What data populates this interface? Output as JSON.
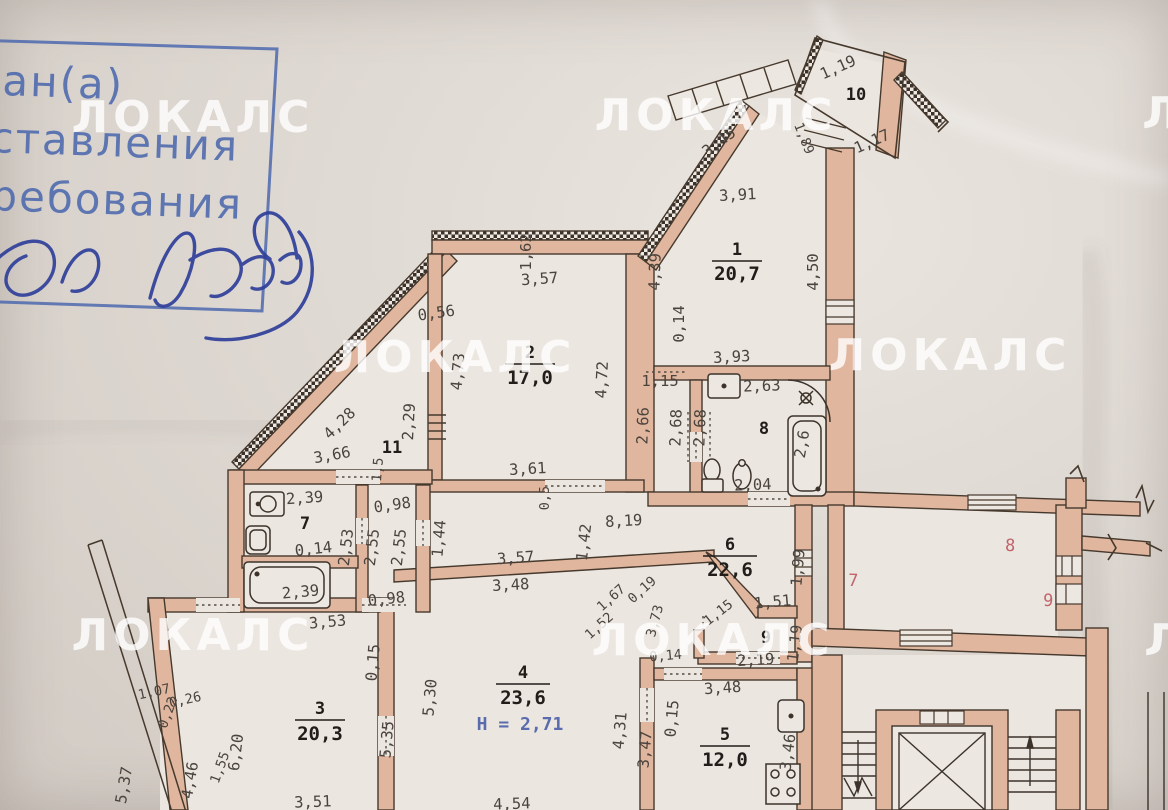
{
  "photo": {
    "watermark": "ЛОКАЛС",
    "watermark_partial": "Л"
  },
  "stamp": {
    "line_1": "ан(а)",
    "line_2": "ставления",
    "line_3": "ребования"
  },
  "colors": {
    "wall_tan": "#e0b69e",
    "stamp_blue": "#4c69ae",
    "signature_blue": "#30409a",
    "neighbor_red": "#c2646c",
    "height_blue": "#5a6cae",
    "dim_text": "#4b443e"
  },
  "plan": {
    "rooms": {
      "r1": {
        "number": "1",
        "area": "20,7"
      },
      "r2": {
        "number": "2",
        "area": "17,0"
      },
      "r3": {
        "number": "3",
        "area": "20,3"
      },
      "r4": {
        "number": "4",
        "area": "23,6"
      },
      "r5": {
        "number": "5",
        "area": "12,0"
      },
      "r6": {
        "number": "6",
        "area": "22,6"
      },
      "r7": {
        "number": "7"
      },
      "r8": {
        "number": "8"
      },
      "r9": {
        "number": "9"
      },
      "r10": {
        "number": "10"
      },
      "r11": {
        "number": "11"
      }
    },
    "height_note": "H = 2,71",
    "neighbor_units": {
      "n7": "7",
      "n8": "8",
      "n9": "9"
    },
    "dims": [
      "3,91",
      "4,39",
      "4,50",
      "3,45",
      "1,19",
      "1,17",
      "1,89",
      "1,15",
      "0,14",
      "3,57",
      "1,62",
      "0,56",
      "4,73",
      "2,29",
      "4,72",
      "3,61",
      "0,5",
      "2,66",
      "2,68",
      "2,68",
      "3,93",
      "2,63",
      "2,6",
      "2,04",
      "4,28",
      "3,66",
      "1,5",
      "2,39",
      "0,14",
      "2,39",
      "2,53",
      "2,55",
      "2,55",
      "0,98",
      "0,98",
      "1,44",
      "8,19",
      "1,42",
      "3,57",
      "3,48",
      "1,99",
      "1,51",
      "1,15",
      "2,19",
      "1,19",
      "0,14",
      "1,67",
      "1,52",
      "0,19",
      "3,73",
      "5,30",
      "5,35",
      "4,31",
      "3,47",
      "0,15",
      "4,54",
      "3,48",
      "3,46",
      "3,53",
      "0,15",
      "6,20",
      "4,46",
      "1,55",
      "5,37",
      "3,51",
      "1,07",
      "0,26",
      "0,22"
    ]
  }
}
